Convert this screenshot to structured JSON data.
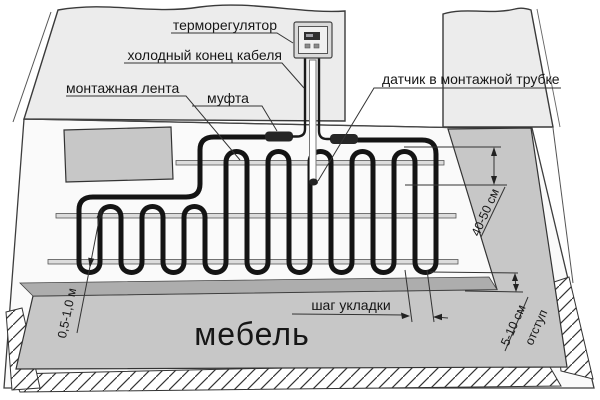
{
  "diagram": {
    "title": "floor-heating-cable-installation-scheme",
    "labels": {
      "thermostat": "терморегулятор",
      "cold_end": "холодный конец кабеля",
      "mounting_tape": "монтажная лента",
      "coupling": "муфта",
      "sensor": "датчик в монтажной трубке",
      "laying_step": "шаг укладки",
      "furniture": "мебель"
    },
    "dimensions": {
      "sensor_offset": "40-50 см",
      "furniture_gap": "0,5-1,0 м",
      "edge_gap": "5-10 см",
      "edge_gap_caption": "отступ"
    },
    "colors": {
      "wall": "#ececec",
      "floor": "#fafafa",
      "zone": "#c7c7c7",
      "zone_band": "#adadad",
      "tape": "#dcdcdc",
      "cable": "#141414",
      "line": "#333333"
    }
  }
}
